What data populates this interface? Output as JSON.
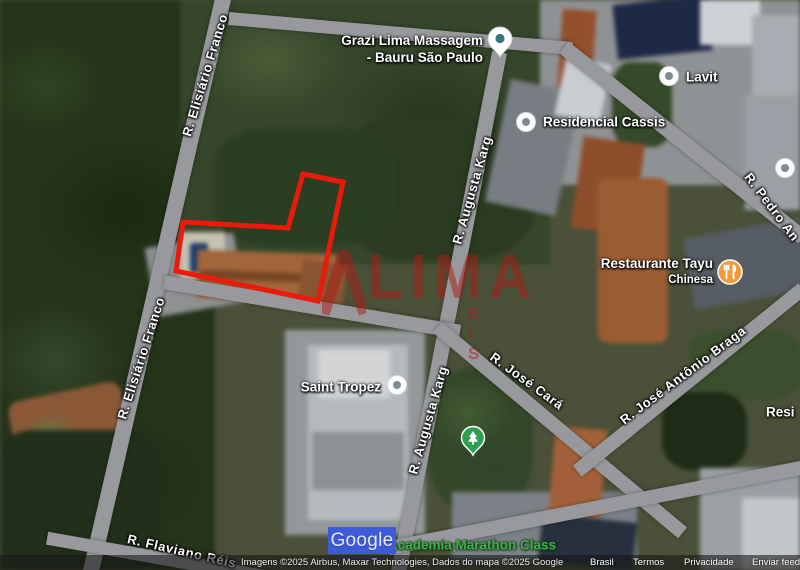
{
  "colors": {
    "outline_red": "#ea1a0c",
    "watermark_red": "#ac1c16",
    "google_box_blue": "#3d5bd8",
    "gym_label_green": "#45ad4d",
    "restaurant_pin_orange": "#ef9a3d",
    "park_pin_green": "#2f9e4f"
  },
  "watermark": {
    "main": "LIMA",
    "sub": "E I S"
  },
  "google_overlay": {
    "label": "Google"
  },
  "property_outline": {
    "points": "303,174 343,182 318,301 176,271 183,222 288,228"
  },
  "streets": [
    {
      "label": "R. Elisiário Franco",
      "x": 205,
      "y": 75,
      "rot": -73
    },
    {
      "label": "R. Elisiário Franco",
      "x": 141,
      "y": 358,
      "rot": -72
    },
    {
      "label": "R. Augusta Karg",
      "x": 472,
      "y": 190,
      "rot": -74
    },
    {
      "label": "R. Augusta Karg",
      "x": 428,
      "y": 420,
      "rot": -74
    },
    {
      "label": "R. Pedro An",
      "x": 772,
      "y": 207,
      "rot": 53
    },
    {
      "label": "R. José Cará",
      "x": 527,
      "y": 381,
      "rot": 36
    },
    {
      "label": "R. José Antônio Braga",
      "x": 683,
      "y": 375,
      "rot": -37
    },
    {
      "label": "R. Flaviano Réis",
      "x": 182,
      "y": 551,
      "rot": 13
    }
  ],
  "pois": [
    {
      "id": "grazi-lima-massagem",
      "lines": [
        "Grazi Lima Massagem",
        "- Bauru São Paulo"
      ],
      "align": "right",
      "x": 483,
      "y": 49,
      "pin": "teardrop-white",
      "pin_x": 500,
      "pin_y": 42
    },
    {
      "id": "lavit",
      "lines": [
        "Lavit"
      ],
      "align": "left",
      "x": 686,
      "y": 77,
      "pin": "circle-white",
      "pin_x": 669,
      "pin_y": 76
    },
    {
      "id": "residencial-cassis",
      "lines": [
        "Residencial Cassis"
      ],
      "align": "left",
      "x": 543,
      "y": 122,
      "pin": "circle-white",
      "pin_x": 526,
      "pin_y": 122
    },
    {
      "id": "restaurante-tayu",
      "lines": [
        "Restaurante Tayu",
        "Chinesa"
      ],
      "small_from": 1,
      "align": "right",
      "x": 713,
      "y": 272,
      "pin": "circle-restaurant",
      "pin_x": 730,
      "pin_y": 272
    },
    {
      "id": "saint-tropez",
      "lines": [
        "Saint Tropez"
      ],
      "align": "right",
      "x": 381,
      "y": 387,
      "pin": "circle-white",
      "pin_x": 397,
      "pin_y": 385
    },
    {
      "id": "academia-marathon-class",
      "lines": [
        "Academia Marathon Class"
      ],
      "align": "left",
      "x": 388,
      "y": 545,
      "color": "green",
      "pin": null
    },
    {
      "id": "residencial-partial",
      "lines": [
        "Resi"
      ],
      "align": "left",
      "x": 766,
      "y": 412,
      "pin": null
    },
    {
      "id": "park-poi",
      "lines": [],
      "align": "left",
      "x": 0,
      "y": 0,
      "pin": "pin-green-tree",
      "pin_x": 473,
      "pin_y": 441
    },
    {
      "id": "poi-unlabeled",
      "lines": [],
      "align": "left",
      "x": 0,
      "y": 0,
      "pin": "circle-white",
      "pin_x": 785,
      "pin_y": 168
    }
  ],
  "attribution": {
    "imagery": "Imagens ©2025 Airbus, Maxar Technologies, Dados do mapa ©2025 Google",
    "links": [
      "Brasil",
      "Termos",
      "Privacidade",
      "Enviar feed"
    ]
  }
}
